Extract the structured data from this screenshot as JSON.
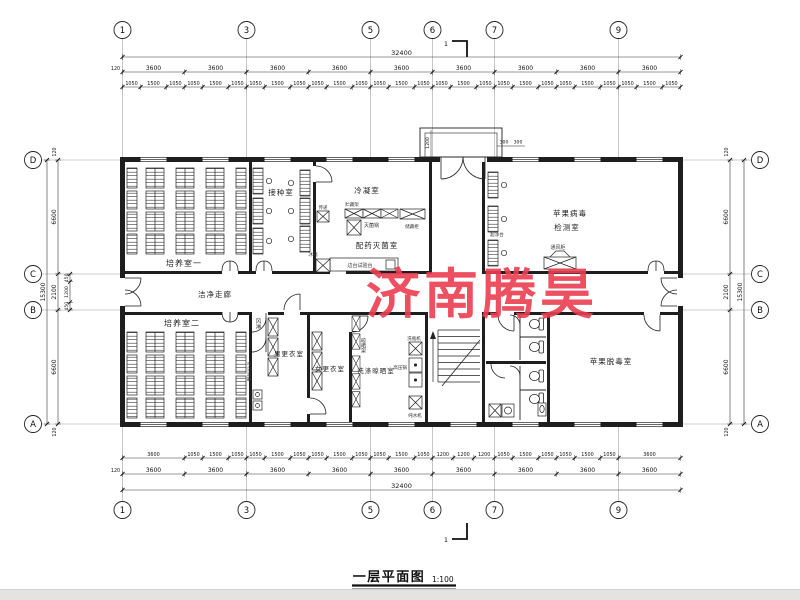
{
  "watermark": {
    "text": "济南腾昊",
    "color": "#ea3e50"
  },
  "title_block": {
    "title": "一层平面图",
    "scale": "1:100"
  },
  "section_mark": {
    "label": "1"
  },
  "axes": {
    "top": [
      "1",
      "3",
      "5",
      "6",
      "7",
      "9"
    ],
    "bottom": [
      "1",
      "3",
      "5",
      "6",
      "7",
      "9"
    ],
    "left": [
      "D",
      "C",
      "B",
      "A"
    ],
    "right": [
      "D",
      "C",
      "B",
      "A"
    ]
  },
  "dims": {
    "margin": "120",
    "top_overall": [
      "32400"
    ],
    "top_bays": [
      "3600",
      "3600",
      "3600",
      "3600",
      "3600",
      "3600",
      "3600",
      "3600",
      "3600"
    ],
    "top_windows": [
      "1050",
      "1500",
      "1050",
      "1050",
      "1500",
      "1050",
      "1050",
      "1500",
      "1050",
      "1050",
      "1500",
      "1050",
      "1050",
      "1500",
      "1050",
      "1050",
      "1500",
      "1050",
      "1050",
      "1500",
      "1050",
      "1050",
      "1500",
      "1050",
      "1050",
      "1500",
      "1050"
    ],
    "bottom_detail": [
      "3600",
      "1050",
      "1500",
      "1050",
      "1050",
      "1500",
      "1050",
      "1050",
      "1500",
      "1050",
      "1050",
      "1500",
      "1050",
      "1200",
      "1200",
      "1200",
      "1050",
      "1500",
      "1050",
      "1050",
      "1500",
      "1050",
      "3600"
    ],
    "bottom_bays": [
      "3600",
      "3600",
      "3600",
      "3600",
      "3600",
      "3600",
      "3600",
      "3600",
      "3600"
    ],
    "bottom_overall": [
      "32400"
    ],
    "left_overall": [
      "15300"
    ],
    "left_main": [
      "6600",
      "2100",
      "6600"
    ],
    "left_sub": [
      "450",
      "1200",
      "450"
    ],
    "right_main": [
      "6600",
      "2100",
      "6600"
    ],
    "right_overall": [
      "15300"
    ],
    "porch_depth": "1200",
    "porch_a": "300",
    "porch_b": "300"
  },
  "rooms": {
    "culture1": "培养室一",
    "inoculation": "接种室",
    "condensing": "冷凝室",
    "prep_steril": "配药灭菌室",
    "virus_test_l1": "苹果病毒",
    "virus_test_l2": "检测室",
    "corridor": "洁净走廊",
    "culture2": "培养室二",
    "men_change": "男更衣室",
    "women_change": "女更衣室",
    "washing": "洗涤晾晒室",
    "detox": "苹果脱毒室"
  },
  "equipment": {
    "pass_box": "传递",
    "autoclave": "灭菌锅",
    "storage_rack": "贮藏架",
    "storage_cabinet": "储藏柜",
    "side_bench": "边台试验台",
    "fridge": "冰箱",
    "clean_bench": "超净台",
    "fume_hood": "通风柜",
    "air_shower": "风淋",
    "bottle_washer": "洗瓶机",
    "pressure_pot": "高压锅",
    "water_purifier": "纯水机",
    "drying_rack": "晾晒架",
    "hand_steril": "手消毒器"
  }
}
